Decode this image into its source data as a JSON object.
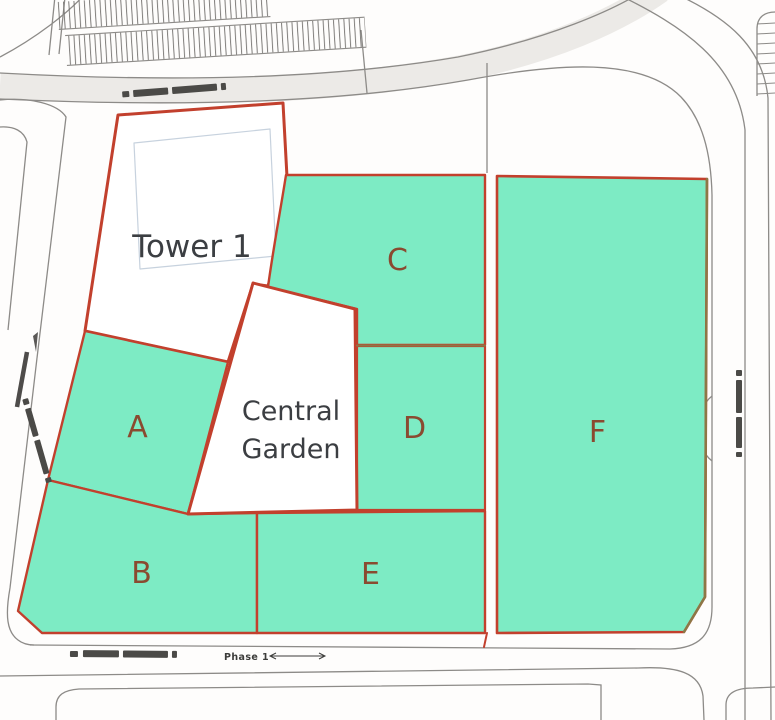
{
  "map": {
    "type": "site-plan",
    "phase_note": "Phase 1",
    "parcels": [
      {
        "id": "tower-1",
        "label": "Tower 1",
        "fill": "#ffffff",
        "kind": "building-parcel"
      },
      {
        "id": "central-garden",
        "label": "Central Garden",
        "label_line1": "Central",
        "label_line2": "Garden",
        "fill": "#ffffff",
        "kind": "garden-parcel"
      },
      {
        "id": "A",
        "label": "A",
        "fill": "#7debc4"
      },
      {
        "id": "B",
        "label": "B",
        "fill": "#7debc4"
      },
      {
        "id": "C",
        "label": "C",
        "fill": "#7debc4"
      },
      {
        "id": "D",
        "label": "D",
        "fill": "#7debc4"
      },
      {
        "id": "E",
        "label": "E",
        "fill": "#7debc4"
      },
      {
        "id": "F",
        "label": "F",
        "fill": "#7debc4"
      }
    ],
    "road_labels": [
      {
        "position": "top-road",
        "legible": false,
        "note": "small illegible street name along top road"
      },
      {
        "position": "bottom-road",
        "legible": false,
        "note": "small illegible street name along bottom road"
      },
      {
        "position": "left-road",
        "legible": false,
        "note": "small illegible street name rotated along left road"
      },
      {
        "position": "right-road",
        "legible": false,
        "note": "small illegible street name rotated along right road"
      }
    ],
    "colors": {
      "parcel_green": "#7debc4",
      "parcel_white": "#ffffff",
      "boundary_red": "#c2402d",
      "divider_olive": "#8c7846",
      "parcel_letter": "#8a4a30",
      "title_text": "#3b3e42",
      "road_line": "#8d8b88",
      "road_fill": "#eceae7"
    }
  }
}
